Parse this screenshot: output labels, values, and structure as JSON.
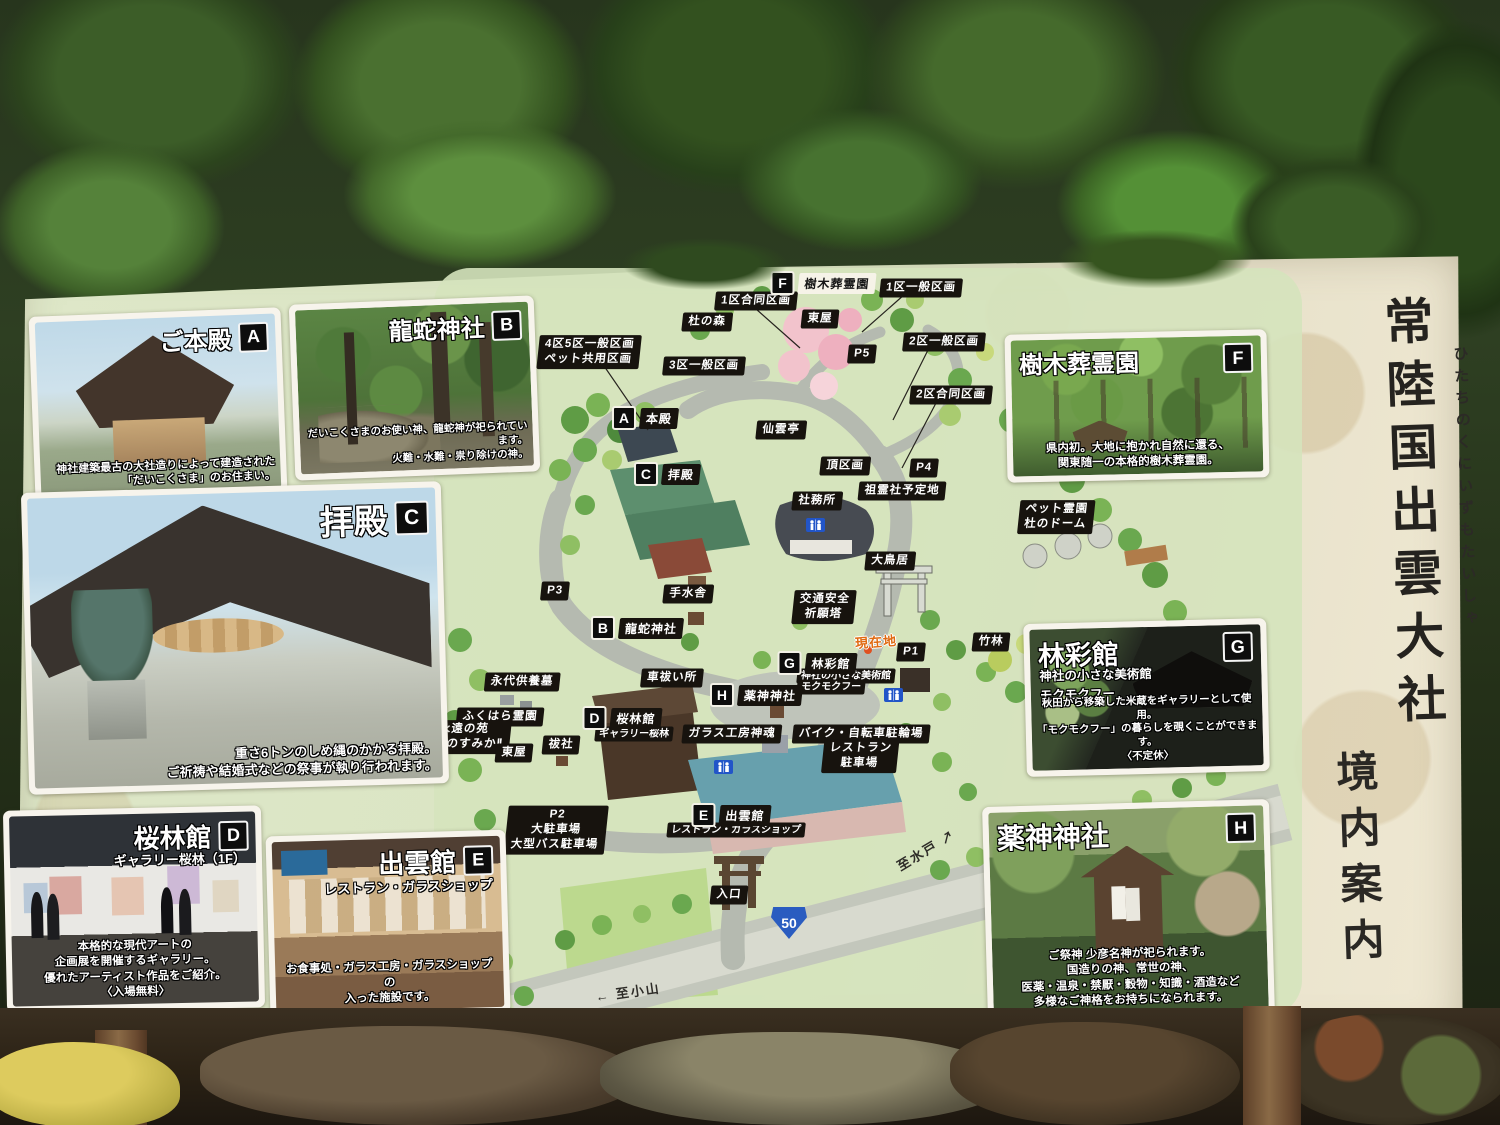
{
  "sign": {
    "title": "常陸国出雲大社",
    "title_furigana": "ひたちのくにいずもたいしゃ",
    "subtitle": "境内案内",
    "panels": {
      "a": {
        "letter": "A",
        "name": "ご本殿",
        "caption": "神社建築最古の大社造りによって建造された\n「だいこくさま」のお住まい。"
      },
      "b": {
        "letter": "B",
        "name": "龍蛇神社",
        "caption": "だいこくさまのお使い神、龍蛇神が祀られています。\n火難・水難・祟り除けの神。"
      },
      "c": {
        "letter": "C",
        "name": "拝殿",
        "caption": "重さ6トンのしめ縄のかかる拝殿。\nご祈祷や結婚式などの祭事が執り行われます。"
      },
      "d": {
        "letter": "D",
        "name": "桜林館",
        "subtitle": "ギャラリー桜林（1F）",
        "caption": "本格的な現代アートの\n企画展を開催するギャラリー。\n優れたアーティスト作品をご紹介。\n〈入場無料〉"
      },
      "e": {
        "letter": "E",
        "name": "出雲館",
        "subtitle": "レストラン・ガラスショップ",
        "caption": "お食事処・ガラス工房・ガラスショップの\n入った施設です。"
      },
      "f": {
        "letter": "F",
        "name": "樹木葬霊園",
        "caption": "県内初。大地に抱かれ自然に還る、\n関東随一の本格的樹木葬霊園。"
      },
      "g": {
        "letter": "G",
        "name": "林彩館",
        "subtitle": "神社の小さな美術館\nモクモクフー",
        "caption": "秋田から移築した米蔵をギャラリーとして使用。\n「モクモクフー」の暮らしを覗くことができます。\n〈不定休〉"
      },
      "h": {
        "letter": "H",
        "name": "薬神神社",
        "caption": "ご祭神 少彦名神が祀られます。\n国造りの神、常世の神、\n医薬・温泉・禁厭・穀物・知識・酒造など\n多様なご神格をお持ちになられます。"
      }
    },
    "map": {
      "labels": {
        "goudou1": {
          "text": "1区合同区画"
        },
        "f_map": {
          "letter": "F",
          "text": "樹木葬霊園"
        },
        "ippan1": {
          "text": "1区一般区画"
        },
        "morinomori": {
          "text": "杜の森"
        },
        "azumaya_top": {
          "text": "東屋"
        },
        "p5": {
          "text": "P5"
        },
        "ippan2": {
          "text": "2区一般区画"
        },
        "goudou2": {
          "text": "2区合同区画"
        },
        "kuiki45": {
          "text": "4区5区一般区画\nペット共用区画"
        },
        "ippan3": {
          "text": "3区一般区画"
        },
        "honden": {
          "letter": "A",
          "text": "本殿"
        },
        "senuntei": {
          "text": "仙雲亭"
        },
        "itadaki": {
          "text": "頂区画"
        },
        "p4": {
          "text": "P4"
        },
        "haiden": {
          "letter": "C",
          "text": "拝殿"
        },
        "shamusho": {
          "text": "社務所"
        },
        "soreisha": {
          "text": "祖霊社予定地"
        },
        "pet_reien": {
          "text": "ペット霊園\n杜のドーム"
        },
        "otorii": {
          "text": "大鳥居"
        },
        "kotsu": {
          "text": "交通安全\n祈願塔"
        },
        "temizusha": {
          "text": "手水舎"
        },
        "ryuja": {
          "letter": "B",
          "text": "龍蛇神社"
        },
        "p3": {
          "text": "P3"
        },
        "eitai": {
          "text": "永代供養墓"
        },
        "kurumaharai": {
          "text": "車祓い所"
        },
        "fukuhara": {
          "text": "ふくはら霊園"
        },
        "towa": {
          "text": "永遠の苑\nついのすみかⅡ"
        },
        "azumaya_low": {
          "text": "東屋"
        },
        "haraesha": {
          "text": "祓社"
        },
        "orin": {
          "letter": "D",
          "text": "桜林館"
        },
        "orin_sub": {
          "text": "ギャラリー桜林"
        },
        "glass": {
          "text": "ガラス工房神魂"
        },
        "yakujin": {
          "letter": "H",
          "text": "薬神神社"
        },
        "rinsai": {
          "letter": "G",
          "text": "林彩館"
        },
        "rinsai_sub1": {
          "text": "神社の小さな美術館"
        },
        "rinsai_sub2": {
          "text": "モクモクフー"
        },
        "p1": {
          "text": "P1"
        },
        "chikurin": {
          "text": "竹林"
        },
        "bike": {
          "text": "バイク・自転車駐輪場"
        },
        "resto_p": {
          "text": "レストラン\n駐車場"
        },
        "izumokan": {
          "letter": "E",
          "text": "出雲館"
        },
        "izumokan_sub": {
          "text": "レストラン・ガラスショップ"
        },
        "p2": {
          "text": "P2\n大駐車場\n大型バス駐車場"
        },
        "iriguchi": {
          "text": "入口"
        },
        "route50": {
          "text": "50"
        },
        "mito": {
          "text": "至水戸 ↗"
        },
        "oyama": {
          "text": "← 至小山"
        },
        "genzaichi": {
          "text": "現在地"
        }
      }
    }
  }
}
